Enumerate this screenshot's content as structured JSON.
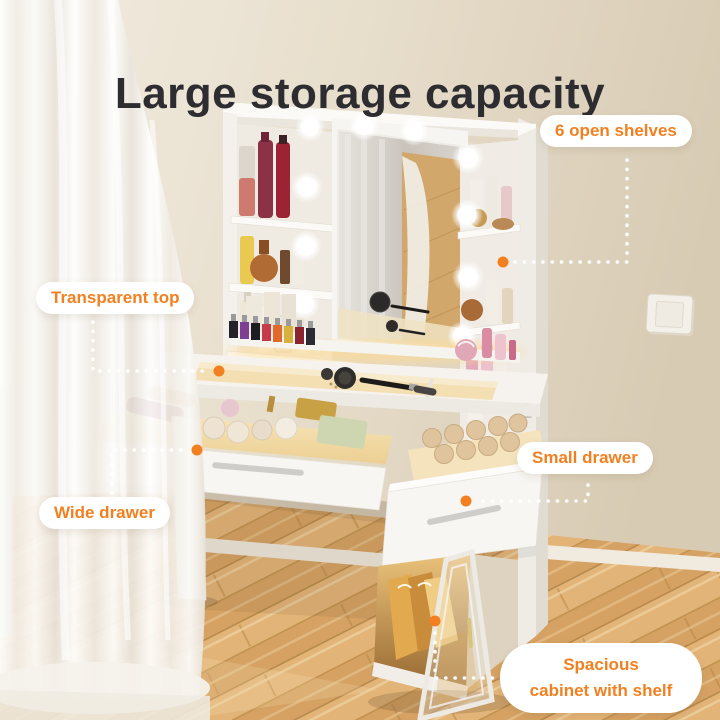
{
  "title": "Large storage capacity",
  "callouts": [
    {
      "id": "open-shelves",
      "label": "6 open shelves"
    },
    {
      "id": "transparent-top",
      "label": "Transparent top"
    },
    {
      "id": "small-drawer",
      "label": "Small drawer"
    },
    {
      "id": "wide-drawer",
      "label": "Wide drawer"
    },
    {
      "id": "spacious-cabinet",
      "label": "Spacious cabinet with shelf",
      "lines": [
        "Spacious",
        "cabinet with shelf"
      ]
    }
  ],
  "colors": {
    "accent": "#f28021",
    "title_text": "#2d2d31",
    "label_bg": "#ffffff",
    "wall": "#e7ddcc",
    "floor_wood": "#ddae72",
    "furniture_white": "#f7f5f2",
    "warm_light": "#f6dfa8"
  }
}
